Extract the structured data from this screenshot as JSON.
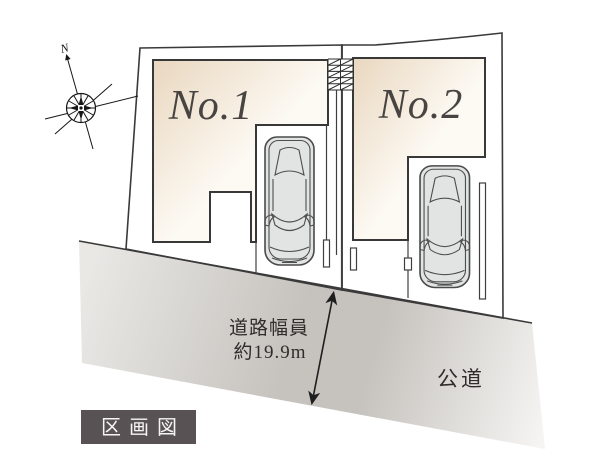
{
  "diagram": {
    "badge": {
      "label": "区画図"
    },
    "lots": [
      {
        "label": "No.1"
      },
      {
        "label": "No.2"
      }
    ],
    "road": {
      "label": "公道",
      "width_caption_line1": "道路幅員",
      "width_caption_line2": "約19.9m"
    },
    "compass": {
      "north_label": "N"
    }
  },
  "colors": {
    "background": "#ffffff",
    "lot_fill": "#d9dcdd",
    "outline_ink": "#3a3a3a",
    "footprint_dark": "#e9d7bf",
    "footprint_light": "#fdfaf4",
    "footprint_mid": "#f6ecdd",
    "road_light": "#e9e8e5",
    "road_mid": "#c6c3be",
    "road_fade": "#f5f4f2",
    "car_fill": "#e2e4e4",
    "car_ink": "#4a4a4a",
    "badge_bg": "#595254",
    "badge_text": "#f6f4f4",
    "label_ink": "#474441",
    "note_ink": "#2f2c2b"
  }
}
